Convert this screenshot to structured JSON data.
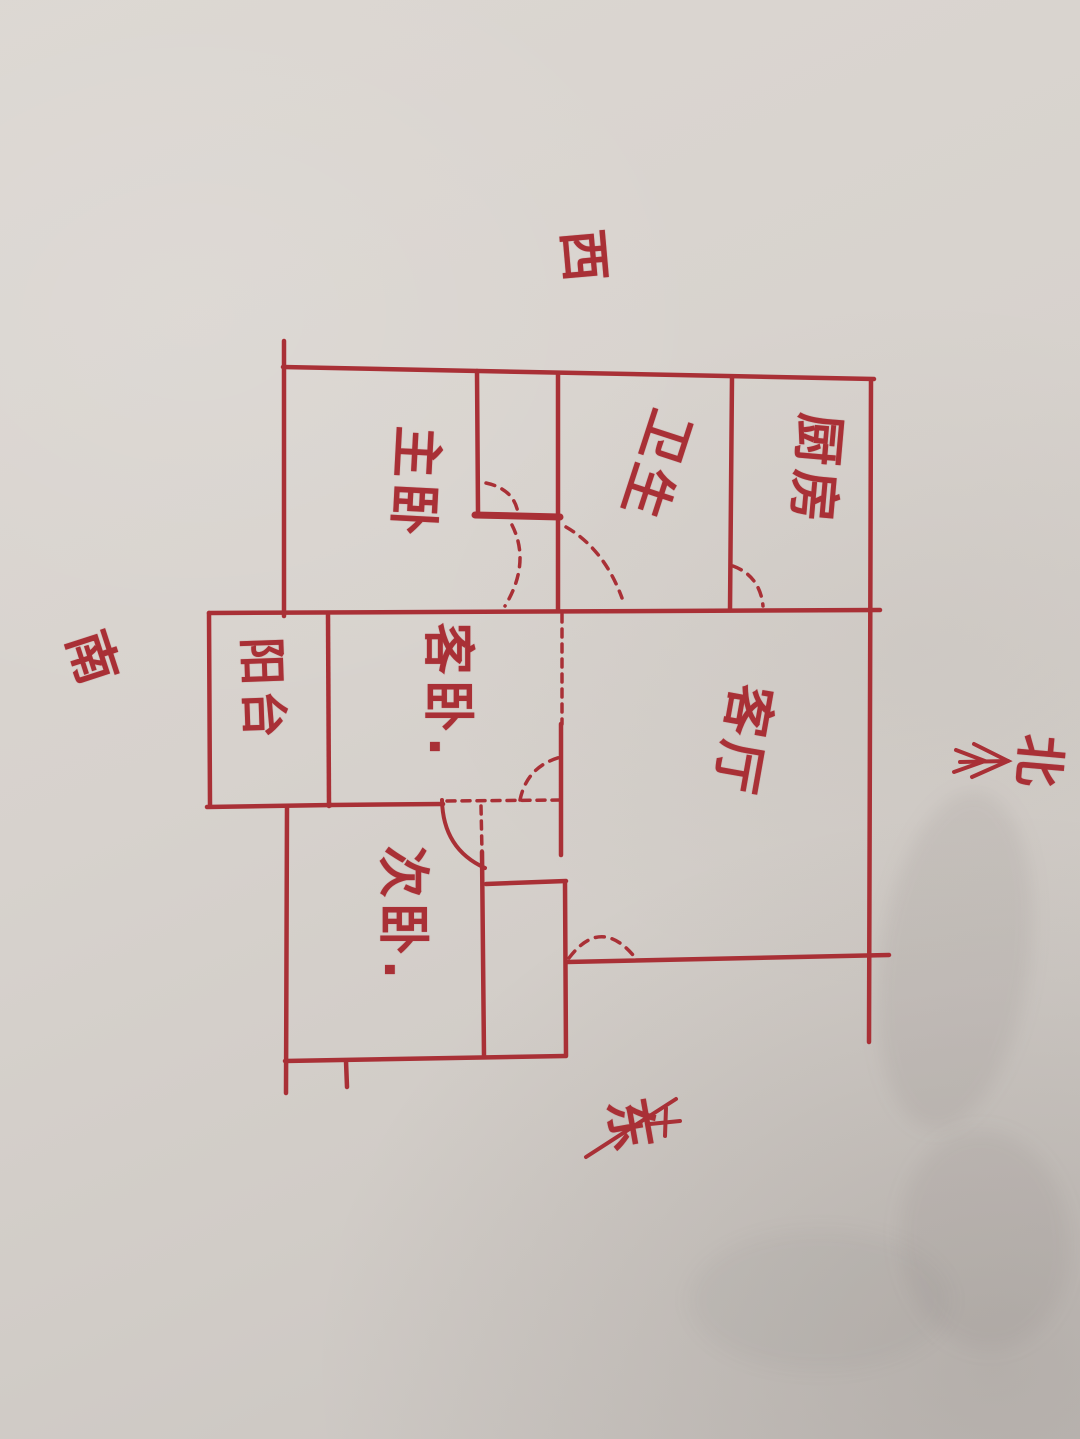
{
  "scene": {
    "type": "hand-drawn apartment floor plan, red marker on paper",
    "ink_color": "#a93036",
    "paper_color": "#d7d2cd"
  },
  "compass": {
    "west": "西",
    "south": "南",
    "north": "北",
    "east": "东"
  },
  "rooms": {
    "master_bedroom": "主卧",
    "bathroom": "卫生",
    "kitchen": "厨房",
    "balcony": "阳台",
    "guest_bedroom": "客卧.",
    "living_room": "客厅",
    "second_bedroom": "次卧."
  }
}
